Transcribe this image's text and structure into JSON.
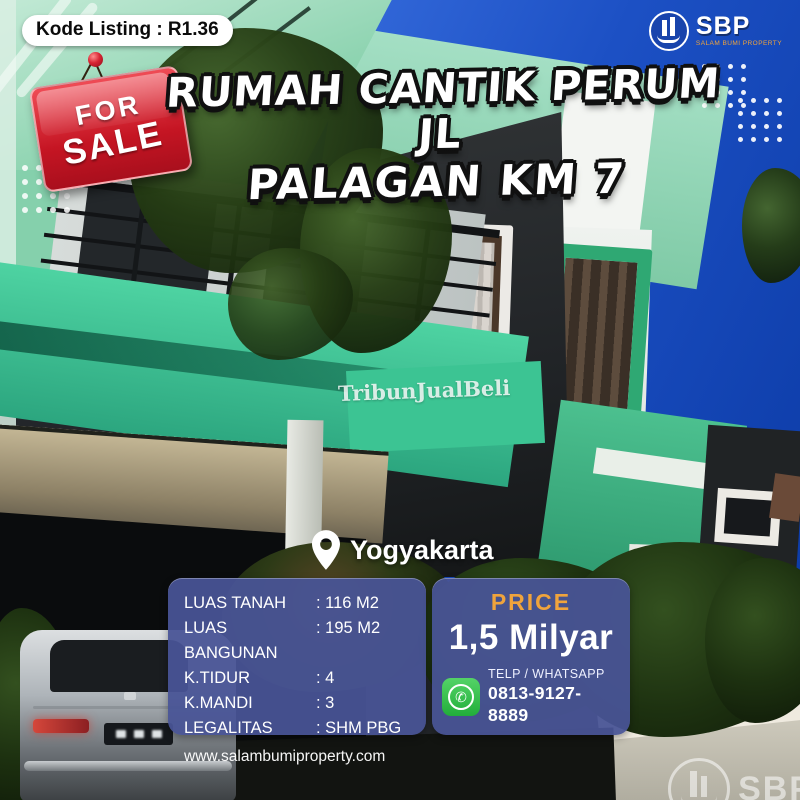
{
  "badge": {
    "kode_listing": "Kode Listing : R1.36"
  },
  "brand": {
    "name": "SBP",
    "tagline": "SALAM BUMI PROPERTY"
  },
  "sale_tag": {
    "line1": "FOR",
    "line2": "SALE"
  },
  "title": {
    "line1": "RUMAH CANTIK PERUM JL",
    "line2": "PALAGAN KM 7"
  },
  "photo_watermark": {
    "text": "TribunJualBeli"
  },
  "location": {
    "name": "Yogyakarta"
  },
  "details": {
    "rows": [
      {
        "label": "LUAS TANAH",
        "value": ": 116 M2"
      },
      {
        "label": "LUAS BANGUNAN",
        "value": ": 195 M2"
      },
      {
        "label": "K.TIDUR",
        "value": ": 4"
      },
      {
        "label": "K.MANDI",
        "value": ": 3"
      },
      {
        "label": "LEGALITAS",
        "value": ": SHM PBG"
      }
    ],
    "website": "www.salambumiproperty.com"
  },
  "price": {
    "label": "PRICE",
    "value": "1,5 Milyar",
    "contact_label": "TELP / WHATSAPP",
    "phone": "0813-9127-8889"
  },
  "footer_watermark": {
    "brand": "SBP"
  },
  "colors": {
    "sky_blue": "#1c50c4",
    "mint_green": "#8fd6b5",
    "emerald_green": "#35c08c",
    "panel_navy": "#485496",
    "price_orange": "#f0a43c",
    "whatsapp_green": "#2ebd43",
    "sale_red": "#c51523",
    "title_white": "#ffffff"
  }
}
